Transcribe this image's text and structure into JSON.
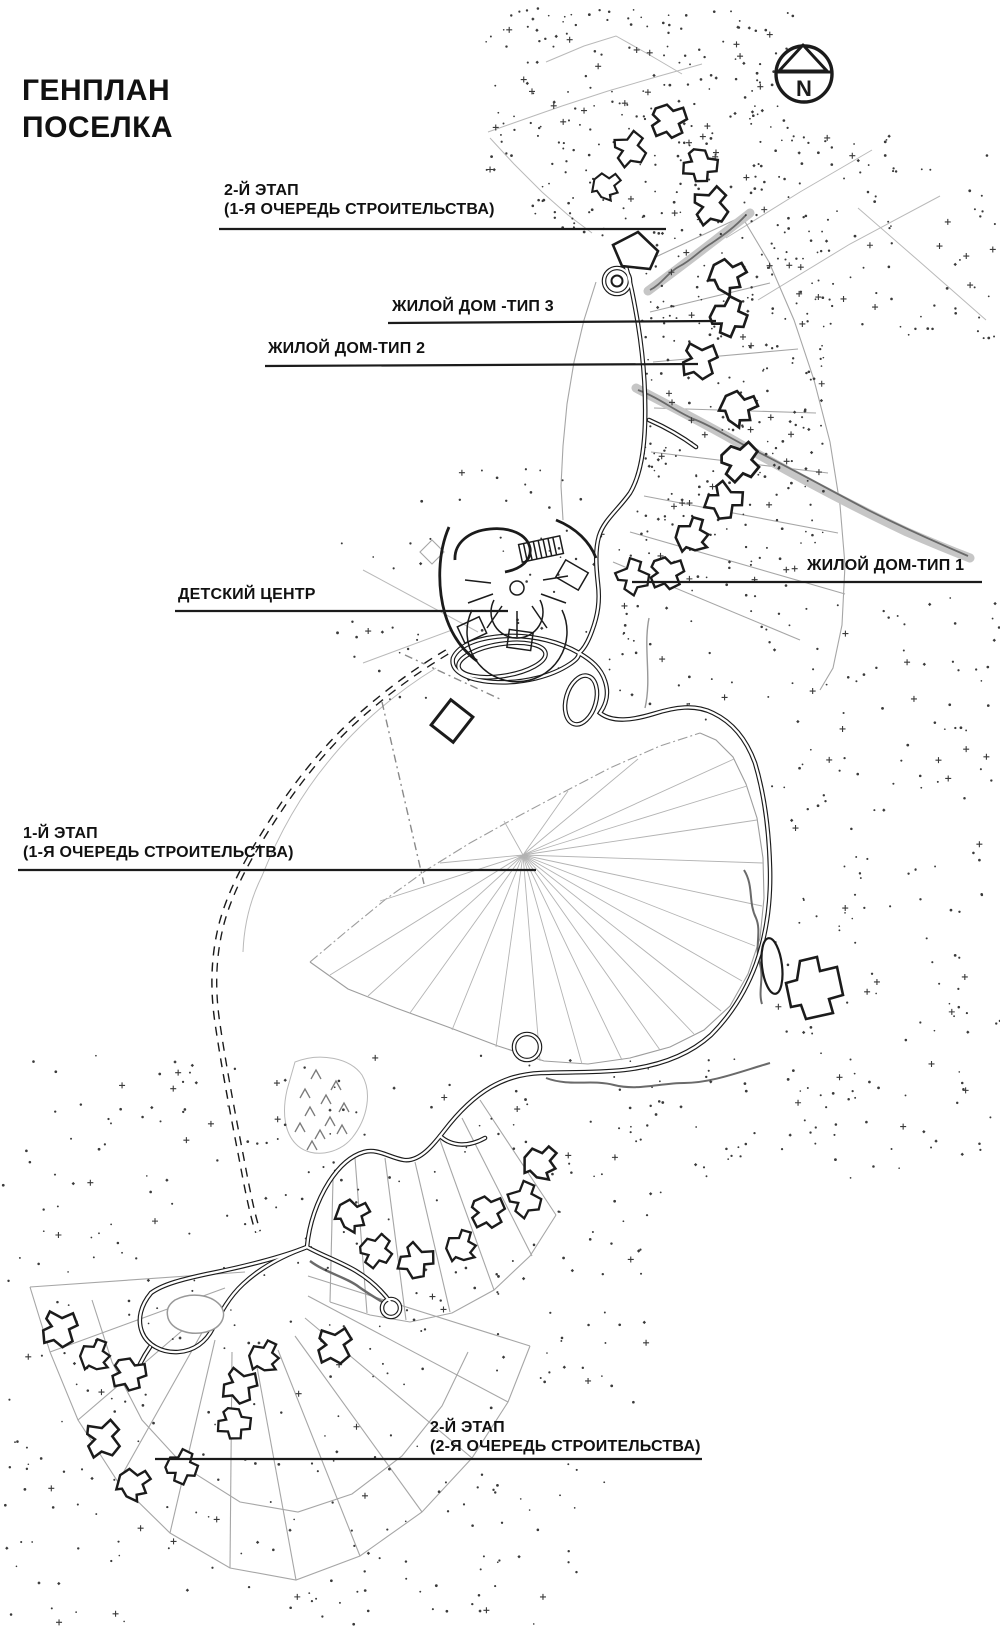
{
  "title": {
    "lines": [
      "ГЕНПЛАН",
      "ПОСЕЛКА"
    ]
  },
  "compass": {
    "label": "N"
  },
  "annotations": {
    "stage2_phase1": {
      "lines": [
        "2-Й ЭТАП",
        "(1-Я ОЧЕРЕДЬ СТРОИТЕЛЬСТВА)"
      ]
    },
    "house_type3": {
      "lines": [
        "ЖИЛОЙ ДОМ -ТИП 3"
      ]
    },
    "house_type2": {
      "lines": [
        "ЖИЛОЙ ДОМ-ТИП 2"
      ]
    },
    "house_type1": {
      "lines": [
        "ЖИЛОЙ ДОМ-ТИП 1"
      ]
    },
    "kids_center": {
      "lines": [
        "ДЕТСКИЙ ЦЕНТР"
      ]
    },
    "stage1_phase1": {
      "lines": [
        "1-Й ЭТАП",
        "(1-Я ОЧЕРЕДЬ СТРОИТЕЛЬСТВА)"
      ]
    },
    "stage2_phase2": {
      "lines": [
        "2-Й ЭТАП",
        "(2-Я ОЧЕРЕДЬ СТРОИТЕЛЬСТВА)"
      ]
    }
  },
  "colors": {
    "ink": "#1b1b1b",
    "parcel_gray": "#a6a6a6",
    "stream_gray": "#c6c6c6",
    "vegetation_dot": "#3a3a3a",
    "background": "#ffffff"
  }
}
